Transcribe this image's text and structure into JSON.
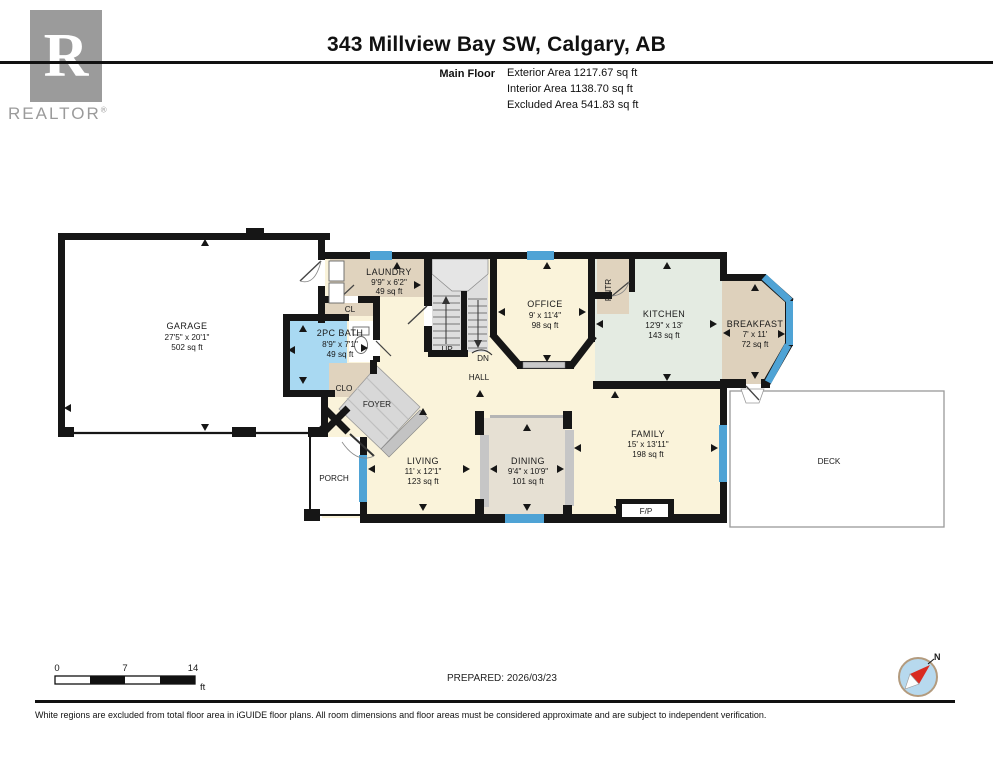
{
  "header": {
    "logo": {
      "letter": "R",
      "brand": "REALTOR",
      "reg": "®"
    },
    "title": "343 Millview Bay SW, Calgary, AB",
    "floor_label": "Main Floor",
    "stats": [
      "Exterior Area 1217.67 sq ft",
      "Interior Area 1138.70 sq ft",
      "Excluded Area 541.83 sq ft"
    ]
  },
  "rooms": [
    {
      "name": "GARAGE",
      "dims": "27'5\" x 20'1\"",
      "area": "502 sq ft"
    },
    {
      "name": "LAUNDRY",
      "dims": "9'9\" x 6'2\"",
      "area": "49 sq ft"
    },
    {
      "name": "2PC BATH",
      "dims": "8'9\" x 7'1\"",
      "area": "49 sq ft"
    },
    {
      "name": "OFFICE",
      "dims": "9' x 11'4\"",
      "area": "98 sq ft"
    },
    {
      "name": "KITCHEN",
      "dims": "12'9\" x 13'",
      "area": "143 sq ft"
    },
    {
      "name": "BREAKFAST",
      "dims": "7' x 11'",
      "area": "72 sq ft"
    },
    {
      "name": "FAMILY",
      "dims": "15' x 13'11\"",
      "area": "198 sq ft"
    },
    {
      "name": "DINING",
      "dims": "9'4\" x 10'9\"",
      "area": "101 sq ft"
    },
    {
      "name": "LIVING",
      "dims": "11' x 12'1\"",
      "area": "123 sq ft"
    }
  ],
  "plan_labels": {
    "cl": "CL",
    "clo": "CLO",
    "foyer": "FOYER",
    "up": "UP",
    "dn": "DN",
    "hall": "HALL",
    "pntr": "PNTR",
    "porch": "PORCH",
    "deck": "DECK",
    "fp": "F/P"
  },
  "scale_bar": {
    "tick0": "0",
    "tick1": "7",
    "tick2": "14",
    "unit": "ft"
  },
  "compass": {
    "north": "N"
  },
  "footer": {
    "prepared": "PREPARED: 2026/03/23",
    "disclaimer": "White regions are excluded from total floor area in iGUIDE floor plans. All room dimensions and floor areas must be considered approximate and are subject to independent verification."
  },
  "colors": {
    "wall": "#161616",
    "interior": "#faf3da",
    "tan": "#e0d3be",
    "dining_floor": "#e6e0d3",
    "kitchen_floor": "#e4ebe2",
    "bath_floor": "#a9d9f2",
    "window": "#4fa3d5",
    "tile_gray": "#d8d8d8",
    "logo_gray": "#9b9b9b",
    "compass_red": "#d92b21",
    "compass_fill": "#b7d9ee"
  }
}
